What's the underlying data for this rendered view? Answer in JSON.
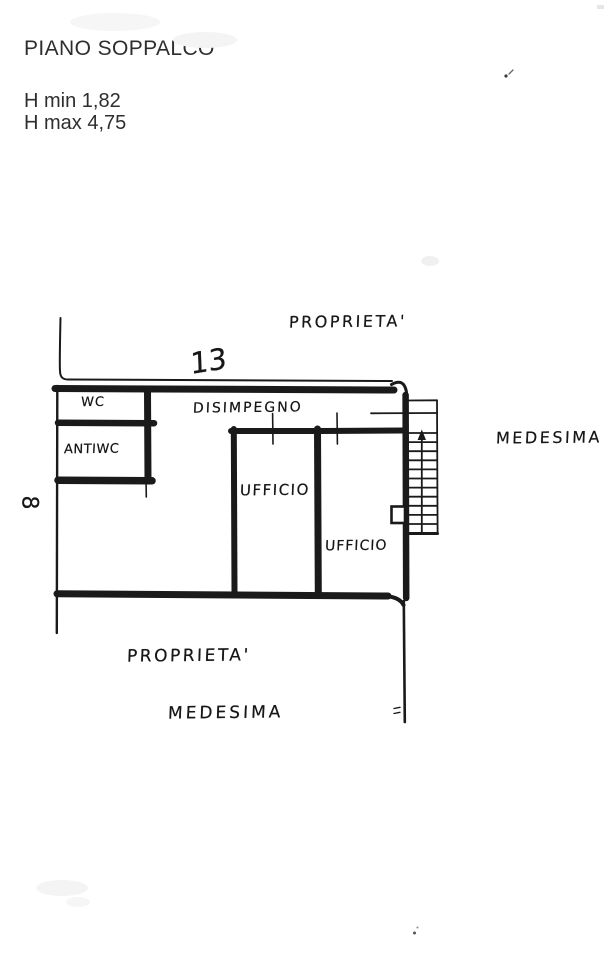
{
  "document": {
    "title": "PIANO SOPPALCO",
    "height_min": "H min 1,82",
    "height_max": "H max 4,75"
  },
  "plan": {
    "dimension_top": "13",
    "dimension_left": "8",
    "boundaries": {
      "top": "PROPRIETA'",
      "right": "MEDESIMA",
      "bottom_line1": "PROPRIETA'",
      "bottom_line2": "MEDESIMA"
    },
    "rooms": [
      {
        "name": "WC"
      },
      {
        "name": "ANTIWC"
      },
      {
        "name": "DISIMPEGNO"
      },
      {
        "name": "UFFICIO"
      },
      {
        "name": "UFFICIO"
      }
    ],
    "colors": {
      "ink": "#1a1a1a",
      "paper": "#ffffff"
    },
    "icons": {
      "stair_arrow": "up-arrow"
    }
  }
}
